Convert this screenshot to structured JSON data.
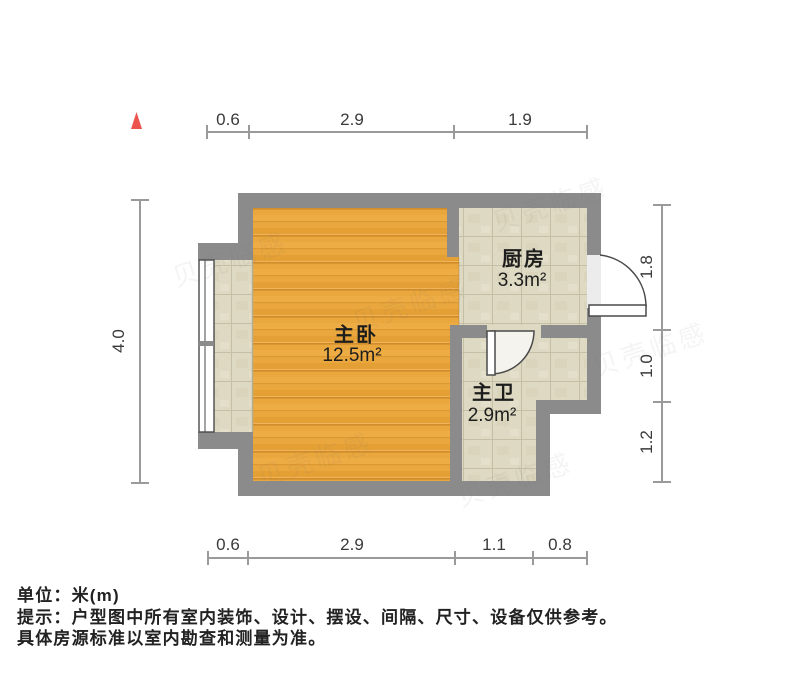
{
  "plan": {
    "rooms": {
      "bedroom": {
        "name": "主卧",
        "area": "12.5m²"
      },
      "kitchen": {
        "name": "厨房",
        "area": "3.3m²"
      },
      "bathroom": {
        "name": "主卫",
        "area": "2.9m²"
      }
    },
    "dimensions": {
      "top": [
        "0.6",
        "2.9",
        "1.9"
      ],
      "bottom": [
        "0.6",
        "2.9",
        "1.1",
        "0.8"
      ],
      "left": [
        "4.0"
      ],
      "right": [
        "1.8",
        "1.0",
        "1.2"
      ]
    }
  },
  "footer": {
    "unit": "单位：米(m)",
    "tip": "提示：户型图中所有室内装饰、设计、摆设、间隔、尺寸、设备仅供参考。",
    "tip2": "具体房源标准以室内勘查和测量为准。"
  },
  "watermark": {
    "text": "贝壳临感"
  },
  "colors": {
    "wall": "#8b8b8b",
    "wood_floor": "#e9a73e",
    "tile_floor": "#ded9c2",
    "north_indicator": "#ee544e",
    "dimension_line": "#9a9a9a"
  }
}
